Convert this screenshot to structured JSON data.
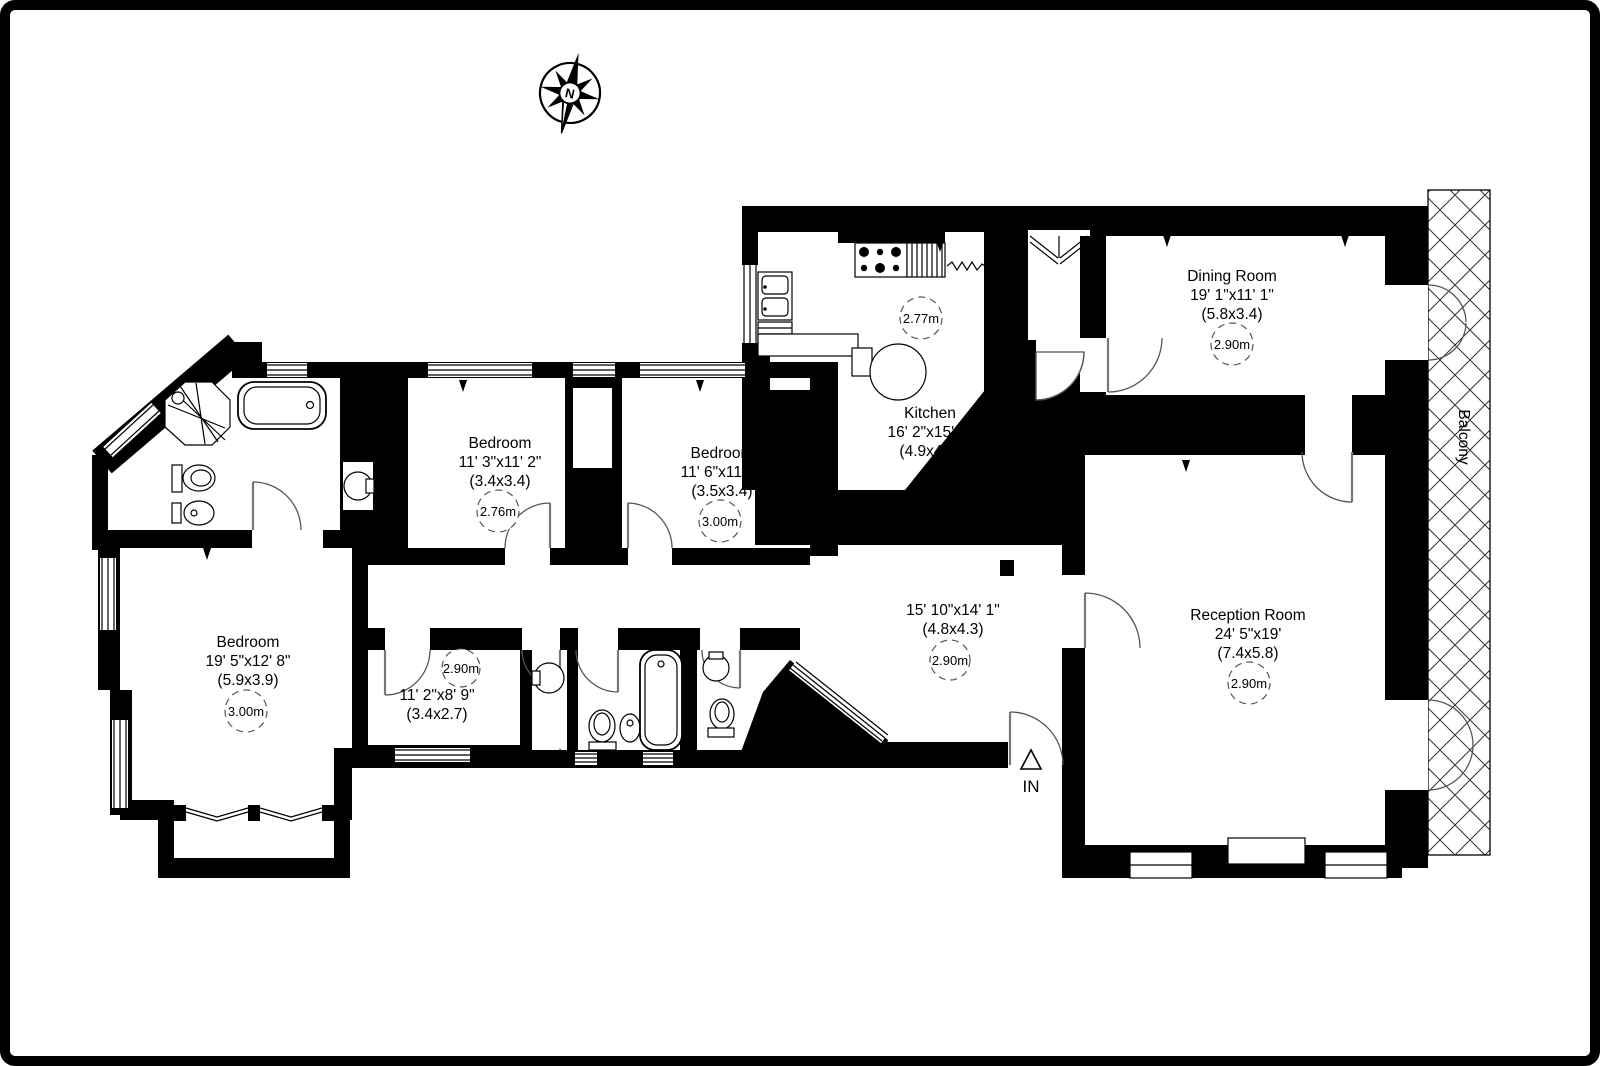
{
  "plan": {
    "compass_label": "N",
    "balcony_label": "Balcony",
    "entrance_label": "IN",
    "colors": {
      "walls": "#000000",
      "background": "#ffffff"
    },
    "rooms": [
      {
        "id": "dining",
        "name": "Dining Room",
        "imperial": "19' 1\"x11' 1\"",
        "metric": "(5.8x3.4)",
        "ceiling": "2.90m"
      },
      {
        "id": "kitchen",
        "name": "Kitchen",
        "imperial": "16' 2\"x15' 1\"",
        "metric": "(4.9x4.6)",
        "ceiling": "2.77m"
      },
      {
        "id": "bedroom1",
        "name": "Bedroom",
        "imperial": "11' 3\"x11' 2\"",
        "metric": "(3.4x3.4)",
        "ceiling": "2.76m"
      },
      {
        "id": "bedroom2",
        "name": "Bedroom",
        "imperial": "11' 6\"x11' 3\"",
        "metric": "(3.5x3.4)",
        "ceiling": "3.00m"
      },
      {
        "id": "bedroom3",
        "name": "Bedroom",
        "imperial": "19' 5\"x12' 8\"",
        "metric": "(5.9x3.9)",
        "ceiling": "3.00m"
      },
      {
        "id": "innerhall",
        "name": "",
        "imperial": "11' 2\"x8' 9\"",
        "metric": "(3.4x2.7)",
        "ceiling": "2.90m"
      },
      {
        "id": "hallway",
        "name": "",
        "imperial": "15' 10\"x14' 1\"",
        "metric": "(4.8x4.3)",
        "ceiling": "2.90m"
      },
      {
        "id": "reception",
        "name": "Reception Room",
        "imperial": "24' 5\"x19'",
        "metric": "(7.4x5.8)",
        "ceiling": "2.90m"
      }
    ]
  }
}
